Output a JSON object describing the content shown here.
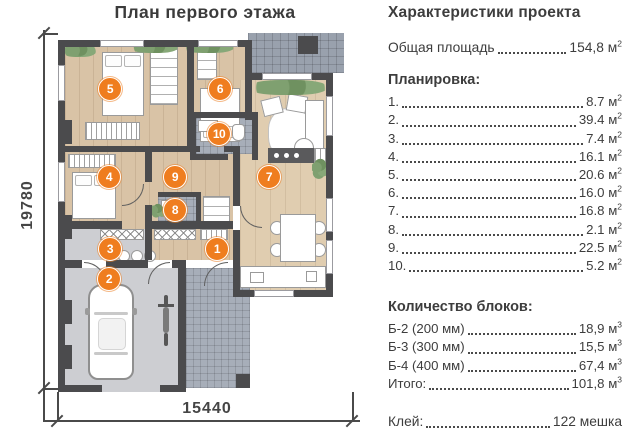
{
  "plan": {
    "title": "План первого этажа",
    "dimensions": {
      "height_label": "19780",
      "width_label": "15440"
    },
    "markers": [
      {
        "num": "1",
        "x": 217,
        "y": 249
      },
      {
        "num": "2",
        "x": 109,
        "y": 279
      },
      {
        "num": "3",
        "x": 110,
        "y": 249
      },
      {
        "num": "4",
        "x": 109,
        "y": 177
      },
      {
        "num": "5",
        "x": 110,
        "y": 89
      },
      {
        "num": "6",
        "x": 220,
        "y": 89
      },
      {
        "num": "7",
        "x": 269,
        "y": 177
      },
      {
        "num": "8",
        "x": 175,
        "y": 210
      },
      {
        "num": "9",
        "x": 175,
        "y": 177
      },
      {
        "num": "10",
        "x": 219,
        "y": 134
      }
    ]
  },
  "panel": {
    "title": "Характеристики проекта",
    "total_area": {
      "label": "Общая площадь",
      "value": "154,8",
      "unit": "м",
      "sup": "2"
    },
    "layout": {
      "heading": "Планировка:",
      "items": [
        {
          "num": "1.",
          "value": "8.7",
          "unit": "м",
          "sup": "2"
        },
        {
          "num": "2.",
          "value": "39.4",
          "unit": "м",
          "sup": "2"
        },
        {
          "num": "3.",
          "value": "7.4",
          "unit": "м",
          "sup": "2"
        },
        {
          "num": "4.",
          "value": "16.1",
          "unit": "м",
          "sup": "2"
        },
        {
          "num": "5.",
          "value": "20.6",
          "unit": "м",
          "sup": "2"
        },
        {
          "num": "6.",
          "value": "16.0",
          "unit": "м",
          "sup": "2"
        },
        {
          "num": "7.",
          "value": "16.8",
          "unit": "м",
          "sup": "2"
        },
        {
          "num": "8.",
          "value": "2.1",
          "unit": "м",
          "sup": "2"
        },
        {
          "num": "9.",
          "value": "22.5",
          "unit": "м",
          "sup": "2"
        },
        {
          "num": "10.",
          "value": "5.2",
          "unit": "м",
          "sup": "2"
        }
      ]
    },
    "blocks": {
      "heading": "Количество блоков:",
      "items": [
        {
          "label": "Б-2 (200 мм)",
          "value": "18,9",
          "unit": "м",
          "sup": "3"
        },
        {
          "label": "Б-3 (300 мм)",
          "value": "15,5",
          "unit": "м",
          "sup": "3"
        },
        {
          "label": "Б-4 (400 мм)",
          "value": "67,4",
          "unit": "м",
          "sup": "3"
        }
      ],
      "total": {
        "label": "Итого:",
        "value": "101,8",
        "unit": "м",
        "sup": "3"
      }
    },
    "glue": {
      "label": "Клей:",
      "value": "122 мешка"
    }
  },
  "colors": {
    "accent_orange": "#ef7d1f",
    "wall": "#4b4b4d",
    "text": "#3d3d3d",
    "wood_floor": "#d9c3a6",
    "garage_floor": "#cdced2",
    "tile_floor": "#a7aeb9",
    "plant_green": "#7fa070"
  }
}
